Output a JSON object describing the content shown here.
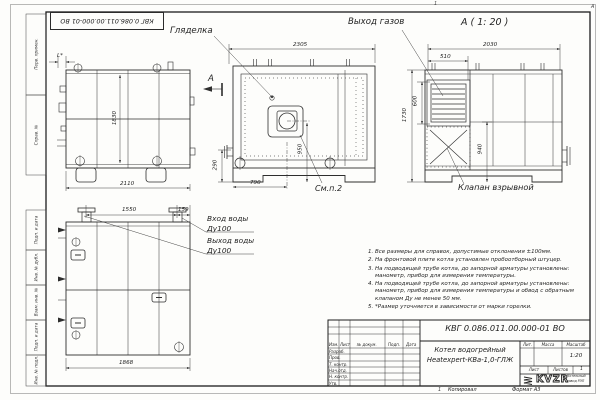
{
  "sheet": {
    "stamp_top": "КВГ 0.086.011.00.000-01 ВО",
    "zone_top": "1",
    "zone_right": "А",
    "zone_bottom": "1",
    "margin_labels": [
      "Перв. примен.",
      "Справ. №",
      "Подп. и дата",
      "Инв. № дубл.",
      "Взам. инв. №",
      "Подп. и дата",
      "Инв. № подл."
    ]
  },
  "views": {
    "side": {
      "dim_l": "L*",
      "dim_height": "1830",
      "dim_width": "2110"
    },
    "front": {
      "label_sight": "Гляделка",
      "section_letter": "А",
      "dim_width": "2305",
      "dim_left": "290",
      "dim_bottom": "790",
      "dim_burner": "950",
      "see_note": "См.п.2"
    },
    "section": {
      "title": "А ( 1: 20 )",
      "label_gas_out": "Выход газов",
      "dim_width": "2030",
      "dim_vent_w": "510",
      "dim_vent_h": "600",
      "dim_height": "1730",
      "dim_lower": "940",
      "label_valve": "Клапан взрывной"
    },
    "bottom": {
      "dim_pipes": "1550",
      "dim_edge": "159",
      "dim_width": "1868",
      "label_in1": "Вход воды",
      "label_in2": "Ду100",
      "label_out1": "Выход воды",
      "label_out2": "Ду100"
    }
  },
  "notes": [
    "1. Все размеры для справок, допустимые отклонения ±100мм.",
    "2. На фронтовой плите котла установлен пробоотборный штуцер.",
    "3. На подводящей трубе котла, до запорной арматуры установлены: манометр, прибор для измерения температуры.",
    "4. На подводящей трубе котла, до запорной арматуры установлены: манометр, прибор для измерения температуры и обвод с обратным клапаном Ду не менее 50 мм.",
    "5. *Размер уточняется в зависимости от марки горелки."
  ],
  "title_block": {
    "doc_number": "КВГ 0.086.011.00.000-01 ВО",
    "name_line1": "Котел водогрейный",
    "name_line2": "Heatexpert-КВа-1,0-ГЛЖ",
    "hdr_izm": "Изм.",
    "hdr_list": "Лист",
    "hdr_doc": "№ докум.",
    "hdr_sign": "Подп.",
    "hdr_date": "Дата",
    "row_0": "Разраб.",
    "row_1": "Пров.",
    "row_2": "Т. контр.",
    "row_3": "Нач.отд.",
    "row_4": "Н. контр.",
    "row_5": "Утв.",
    "lit": "Лит.",
    "mass": "Масса",
    "scale_label": "Масштаб",
    "scale_value": "1:20",
    "sheet_label": "Лист",
    "sheets_label": "Листов",
    "sheets_value": "1",
    "logo_text": "KVZR",
    "logo_sub1": "Котельный",
    "logo_sub2": "завод РЭП",
    "copied": "Копировал",
    "format": "Формат А3"
  }
}
